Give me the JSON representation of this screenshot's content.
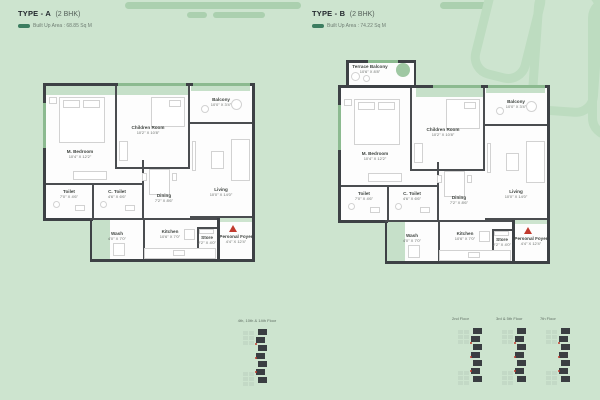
{
  "header": {
    "type_a": {
      "title": "TYPE - A",
      "config": "(2 BHK)",
      "area": "Built Up Area : 68.85 Sq M"
    },
    "type_b": {
      "title": "TYPE - B",
      "config": "(2 BHK)",
      "area": "Built Up Area : 74.22 Sq M"
    }
  },
  "plans": {
    "a": {
      "rooms": {
        "m_bedroom": {
          "name": "M. Bedroom",
          "dims": "10'4\" X 12'2\""
        },
        "children_room": {
          "name": "Children Room",
          "dims": "10'2\" X 10'8\""
        },
        "balcony": {
          "name": "Balcony",
          "dims": "10'0\" X 3'4\""
        },
        "living": {
          "name": "Living",
          "dims": "10'0\" X 14'0\""
        },
        "dining": {
          "name": "Dining",
          "dims": "7'2\" X 8'6\""
        },
        "toilet": {
          "name": "Toilet",
          "dims": "7'0\" X 4'6\""
        },
        "c_toilet": {
          "name": "C. Toilet",
          "dims": "4'6\" X 6'6\""
        },
        "wash": {
          "name": "Wash",
          "dims": "4'0\" X 7'0\""
        },
        "kitchen": {
          "name": "Kitchen",
          "dims": "10'6\" X 7'0\""
        },
        "store": {
          "name": "Store",
          "dims": "2'2\" X 4'0\""
        },
        "personal_foyer": {
          "name": "Personal Foyer",
          "dims": "4'4\" X 12'4\""
        }
      }
    },
    "b": {
      "rooms": {
        "terrace_balcony": {
          "name": "Terrace Balcony",
          "dims": "10'6\" X 8'8\""
        },
        "m_bedroom": {
          "name": "M. Bedroom",
          "dims": "10'4\" X 12'2\""
        },
        "children_room": {
          "name": "Children Room",
          "dims": "10'2\" X 10'8\""
        },
        "balcony": {
          "name": "Balcony",
          "dims": "10'0\" X 3'4\""
        },
        "living": {
          "name": "Living",
          "dims": "10'0\" X 14'0\""
        },
        "dining": {
          "name": "Dining",
          "dims": "7'2\" X 8'6\""
        },
        "toilet": {
          "name": "Toilet",
          "dims": "7'0\" X 4'6\""
        },
        "c_toilet": {
          "name": "C. Toilet",
          "dims": "4'6\" X 6'6\""
        },
        "wash": {
          "name": "Wash",
          "dims": "4'0\" X 7'0\""
        },
        "kitchen": {
          "name": "Kitchen",
          "dims": "10'6\" X 7'0\""
        },
        "store": {
          "name": "Store",
          "dims": "2'2\" X 4'0\""
        },
        "personal_foyer": {
          "name": "Personal Foyer",
          "dims": "4'4\" X 12'4\""
        }
      }
    }
  },
  "keyplans": [
    {
      "title": "4th, 10th & 14th Floor"
    },
    {
      "title": "2nd Floor"
    },
    {
      "title": "3rd & 5th Floor"
    },
    {
      "title": "7th Floor"
    }
  ],
  "colors": {
    "background": "#cde4cf",
    "wall": "#3d4145",
    "green_accent": "#8cba90",
    "deco_bar": "#abd0af",
    "entry_marker_red": "#c13a2e",
    "area_dash": "#3c7d60"
  }
}
